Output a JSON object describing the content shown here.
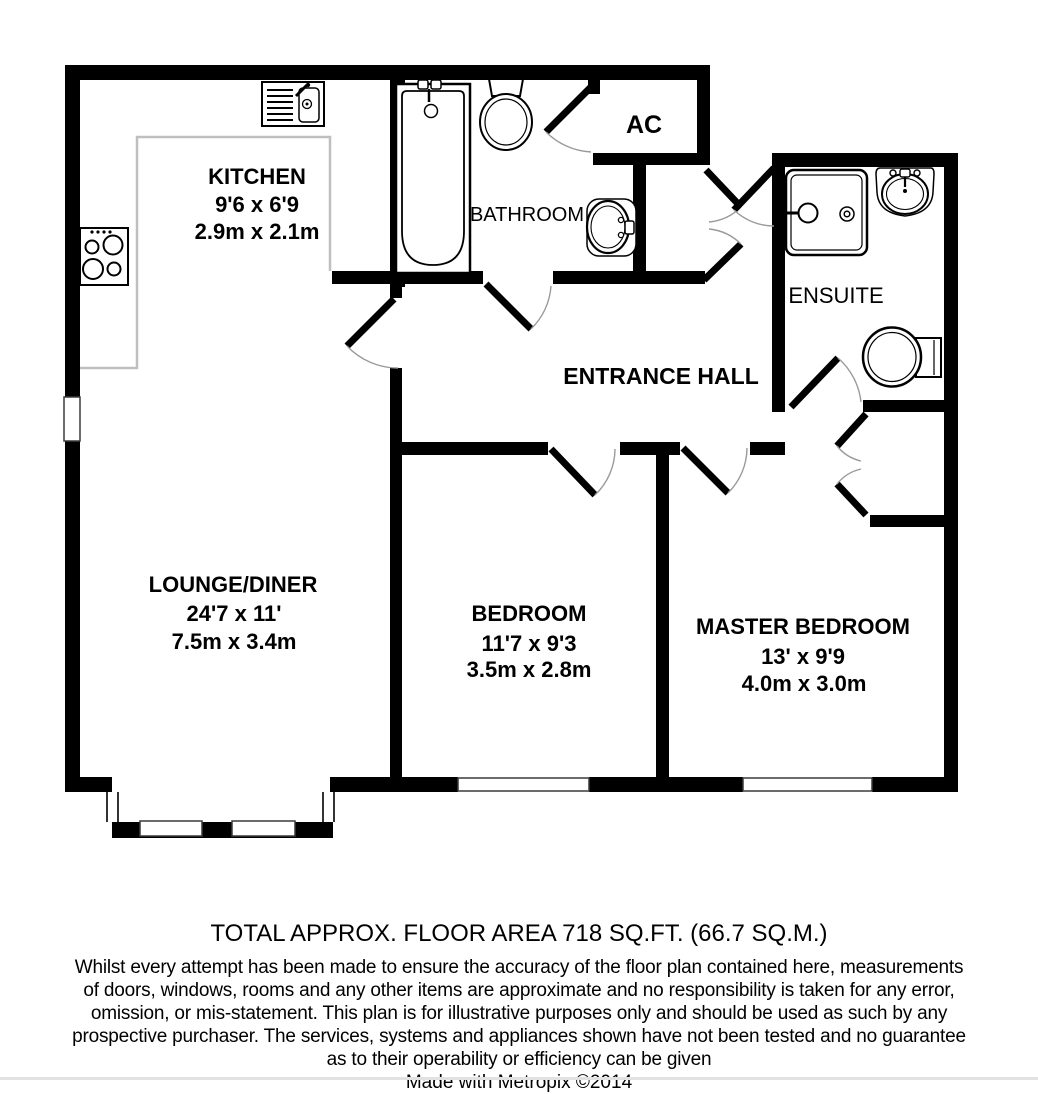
{
  "plan": {
    "rooms": {
      "kitchen": {
        "name": "KITCHEN",
        "size_imperial": "9'6 x 6'9",
        "size_metric": "2.9m x 2.1m"
      },
      "lounge_diner": {
        "name": "LOUNGE/DINER",
        "size_imperial": "24'7 x 11'",
        "size_metric": "7.5m x 3.4m"
      },
      "bedroom": {
        "name": "BEDROOM",
        "size_imperial": "11'7 x 9'3",
        "size_metric": "3.5m x 2.8m"
      },
      "master_bedroom": {
        "name": "MASTER BEDROOM",
        "size_imperial": "13' x 9'9",
        "size_metric": "4.0m x 3.0m"
      },
      "bathroom": {
        "name": "BATHROOM"
      },
      "ensuite": {
        "name": "ENSUITE"
      },
      "entrance_hall": {
        "name": "ENTRANCE HALL"
      },
      "airing_cupboard": {
        "name": "AC"
      }
    },
    "fixtures": {
      "kitchen_sink": "sink-with-drainer",
      "hob": "four-ring-hob",
      "bathtub": "bathtub-with-taps",
      "bathroom_toilet": "toilet",
      "bathroom_basin": "wash-basin",
      "shower": "shower-tray",
      "ensuite_basin": "wash-basin",
      "ensuite_toilet": "toilet",
      "wardrobe": "double-door-cupboard"
    },
    "colors": {
      "wall": "#000000",
      "door_arc": "#9a9a9a",
      "counter_outline": "#bfbfbf",
      "background": "#ffffff"
    }
  },
  "footer": {
    "area_title": "TOTAL APPROX. FLOOR AREA 718 SQ.FT. (66.7 SQ.M.)",
    "disclaimer_lines": [
      "Whilst every attempt has been made to ensure the accuracy of the floor plan contained here, measurements",
      "of doors, windows, rooms and any other items are approximate and no responsibility is taken for any error,",
      "omission, or mis-statement. This plan is for illustrative purposes only and should be used as such by any",
      "prospective purchaser. The services, systems and appliances shown have not been tested and no guarantee",
      "as to their operability or efficiency can be given"
    ],
    "credit": "Made with Metropix ©2014"
  }
}
